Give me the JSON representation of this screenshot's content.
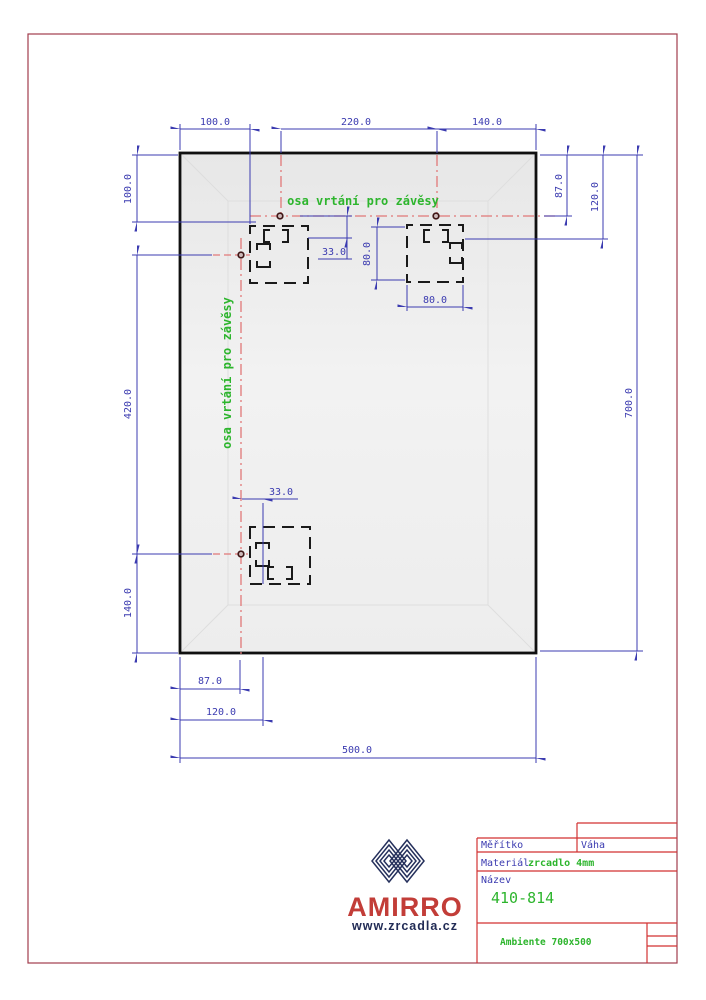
{
  "drawing": {
    "axis_labels": {
      "horizontal": "osa vrtání pro závěsy",
      "vertical": "osa vrtání pro závěsy"
    },
    "dims": {
      "top_left": "100.0",
      "top_mid": "220.0",
      "top_right": "140.0",
      "right_87": "87.0",
      "right_120": "120.0",
      "right_700": "700.0",
      "left_100": "100.0",
      "left_420": "420.0",
      "left_140": "140.0",
      "bottom_87": "87.0",
      "bottom_120": "120.0",
      "bottom_500": "500.0",
      "offset_top_33": "33.0",
      "offset_bottom_33": "33.0",
      "hinge_height_80": "80.0",
      "hinge_width_80": "80.0"
    },
    "colors": {
      "dimension_blue": "#3b3bb0",
      "axis_red": "#e17878",
      "frame_red": "#a23c4c",
      "block_red": "#d23232",
      "annotation_green": "#2db52d",
      "mirror_fill": "#ececec"
    }
  },
  "title_block": {
    "scale_label": "Měřítko",
    "weight_label": "Váha",
    "material_label": "Materiál",
    "material_value": "zrcadlo 4mm",
    "name_label": "Název",
    "name_value": "410-814",
    "product": "Ambiente 700x500"
  },
  "logo": {
    "brand": "AMIRRO",
    "website": "www.zrcadla.cz"
  }
}
